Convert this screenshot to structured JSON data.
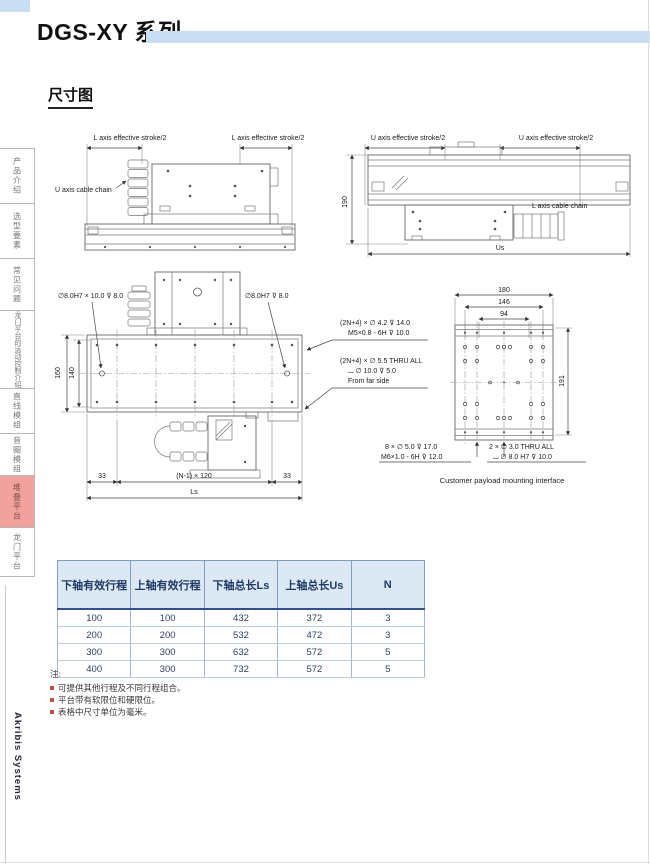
{
  "header": {
    "title": "DGS-XY 系列",
    "accent_color": "#c9def0"
  },
  "section_title": "尺寸图",
  "sidebar": {
    "active_color": "#f2a29c",
    "items": [
      {
        "label": "产品介绍",
        "active": false
      },
      {
        "label": "选型要素",
        "active": false
      },
      {
        "label": "常见问题",
        "active": false
      },
      {
        "label": "龙门平台的运动控制介绍",
        "active": false
      },
      {
        "label": "直线模组",
        "active": false
      },
      {
        "label": "音圈模组",
        "active": false
      },
      {
        "label": "堆叠平台",
        "active": true
      },
      {
        "label": "龙门平台",
        "active": false
      }
    ]
  },
  "brand": "Akribis Systems",
  "drawings": {
    "top_left": {
      "stroke_label_left": "L axis effective stroke/2",
      "stroke_label_right": "L axis effective stroke/2",
      "cable_chain_label": "U axis cable chain"
    },
    "top_right": {
      "stroke_label_left": "U axis effective stroke/2",
      "stroke_label_right": "U axis effective stroke/2",
      "height_dim": "190",
      "cable_chain_label": "L axis cable chain",
      "width_dim": "Us"
    },
    "plan_view": {
      "pin_label_left": "∅8.0H7 × 10.0 ⊽ 8.0",
      "pin_label_right": "∅8.0H7 ⊽ 8.0",
      "dim_160": "160",
      "dim_140": "140",
      "dim_33_left": "33",
      "dim_pitch": "(N-1) × 120",
      "dim_33_right": "33",
      "dim_length": "Ls",
      "note1_line1": "(2N+4) × ∅ 4.2 ⊽ 14.0",
      "note1_line2": "M5×0.8 - 6H ⊽ 10.0",
      "note2_line1": "(2N+4) × ∅ 5.5 THRU ALL",
      "note2_line2": "⌴ ∅ 10.0 ⊽ 5.0",
      "note2_line3": "From far side"
    },
    "payload_view": {
      "dim_180": "180",
      "dim_146": "146",
      "dim_94": "94",
      "dim_191": "191",
      "note1_line1": "8 × ∅ 5.0 ⊽ 17.0",
      "note1_line2": "M6×1.0 - 6H ⊽ 12.0",
      "note2_line1": "2 × ∅ 3.0 THRU ALL",
      "note2_line2": "⌴ ∅ 8.0 H7 ⊽ 10.0",
      "caption": "Customer payload mounting interface"
    }
  },
  "table": {
    "headers": [
      "下轴有效行程",
      "上轴有效行程",
      "下轴总长Ls",
      "上轴总长Us",
      "N"
    ],
    "rows": [
      [
        "100",
        "100",
        "432",
        "372",
        "3"
      ],
      [
        "200",
        "200",
        "532",
        "472",
        "3"
      ],
      [
        "300",
        "300",
        "632",
        "572",
        "5"
      ],
      [
        "400",
        "300",
        "732",
        "572",
        "5"
      ]
    ]
  },
  "notes": {
    "title": "注:",
    "items": [
      "可提供其他行程及不同行程组合。",
      "平台带有软限位和硬限位。",
      "表格中尺寸单位为毫米。"
    ]
  }
}
